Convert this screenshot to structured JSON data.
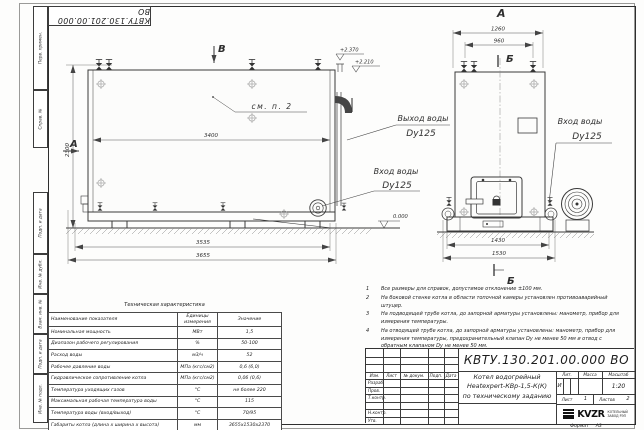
{
  "sheet": {
    "corner_stamp": "КВТУ.130.201.00.000  ВО",
    "strip_labels": [
      "Перв. примен.",
      "Справ. №",
      "Подп. и дата",
      "Инв. № дубл.",
      "Взам. инв. №",
      "Подп. и дата",
      "Инв. № подл."
    ],
    "format_label": "Формат",
    "format_value": "А3"
  },
  "drawing": {
    "front": {
      "section_left": "А",
      "section_top": "В",
      "see_note": "см. п. 2",
      "dim_width": "3400",
      "dim_height": "2300",
      "dim_frame": "3535",
      "dim_overall": "3655",
      "elev_upper": "+2.370",
      "elev_lower": "+2.210",
      "outlet_line1": "Выход воды",
      "outlet_line2": "Dy125",
      "inlet_line1": "Вход воды",
      "inlet_line2": "Dy125"
    },
    "side": {
      "view_label": "А",
      "section_top": "Б",
      "section_bottom": "Б",
      "dim_overall_top": "1260",
      "dim_inner_top": "960",
      "dim_frame": "1430",
      "dim_overall": "1530",
      "elev_zero": "0.000",
      "inlet_line1": "Вход воды",
      "inlet_line2": "Dy125"
    }
  },
  "tech_table": {
    "title": "Техническая характеристика",
    "headers": [
      "Наименование показателя",
      "Единицы измерения",
      "Значение"
    ],
    "rows": [
      {
        "name": "Номинальная мощность",
        "unit": "МВт",
        "value": "1,5"
      },
      {
        "name": "Диапазон рабочего регулирования",
        "unit": "%",
        "value": "50-100"
      },
      {
        "name": "Расход воды",
        "unit": "м3/ч",
        "value": "52"
      },
      {
        "name": "Рабочее давление воды",
        "unit": "МПа (кгс/см2)",
        "value": "0,6 (6,0)"
      },
      {
        "name": "Гидравлическое сопротивление котла",
        "unit": "МПа (кгс/см2)",
        "value": "0,06 (0,6)"
      },
      {
        "name": "Температура уходящих газов",
        "unit": "°С",
        "value": "не более 220"
      },
      {
        "name": "Максимальная рабочая температура воды",
        "unit": "°С",
        "value": "115"
      },
      {
        "name": "Температура воды (вход/выход)",
        "unit": "°С",
        "value": "70/95"
      },
      {
        "name": "Габариты котла (длина х ширина х высота)",
        "unit": "мм",
        "value": "3655х1530х2370"
      }
    ]
  },
  "notes": {
    "items": [
      {
        "num": "1",
        "text": "Все размеры для справок, допустимое отклонение ±100 мм."
      },
      {
        "num": "2",
        "text": "На боковой стенке котла в области топочной камеры установлен противоаварийный штуцер."
      },
      {
        "num": "3",
        "text": "На подводящей трубе котла, до запорной арматуры установлены: манометр, прибор для измерения температуры."
      },
      {
        "num": "4",
        "text": "На отводящей трубе котла, до запорной арматуры установлены: манометр, прибор для измерения температуры, предохранительный клапан Dу не менее 50 мм и отвод с обратным клапаном Dу не менее 50 мм."
      }
    ]
  },
  "title_block": {
    "doc_number": "КВТУ.130.201.00.000  ВО",
    "product_line1": "Котел водогрейный",
    "product_line2": "Heatexpert-КВр-1,5-К(К)",
    "product_line3": "по техническому заданию",
    "col_izm": "Изм.",
    "col_list": "Лист",
    "col_doc": "№ докум.",
    "col_podp": "Подп.",
    "col_data": "Дата",
    "row_razrab": "Разраб.",
    "row_prov": "Пров.",
    "row_tkontr": "Т.контр.",
    "row_nkontr": "Н.контр.",
    "row_utv": "Утв.",
    "lit_label": "Лит.",
    "lit_value": "И",
    "massa_label": "Масса",
    "scale_label": "Масштаб",
    "scale_value": "1:20",
    "sheet_label": "Лист",
    "sheet_value": "1",
    "sheets_label": "Листов",
    "sheets_value": "2",
    "logo_text": "KVZR",
    "logo_sub1": "КОТЕЛЬНЫЙ",
    "logo_sub2": "ЗАВОД РЭП"
  }
}
